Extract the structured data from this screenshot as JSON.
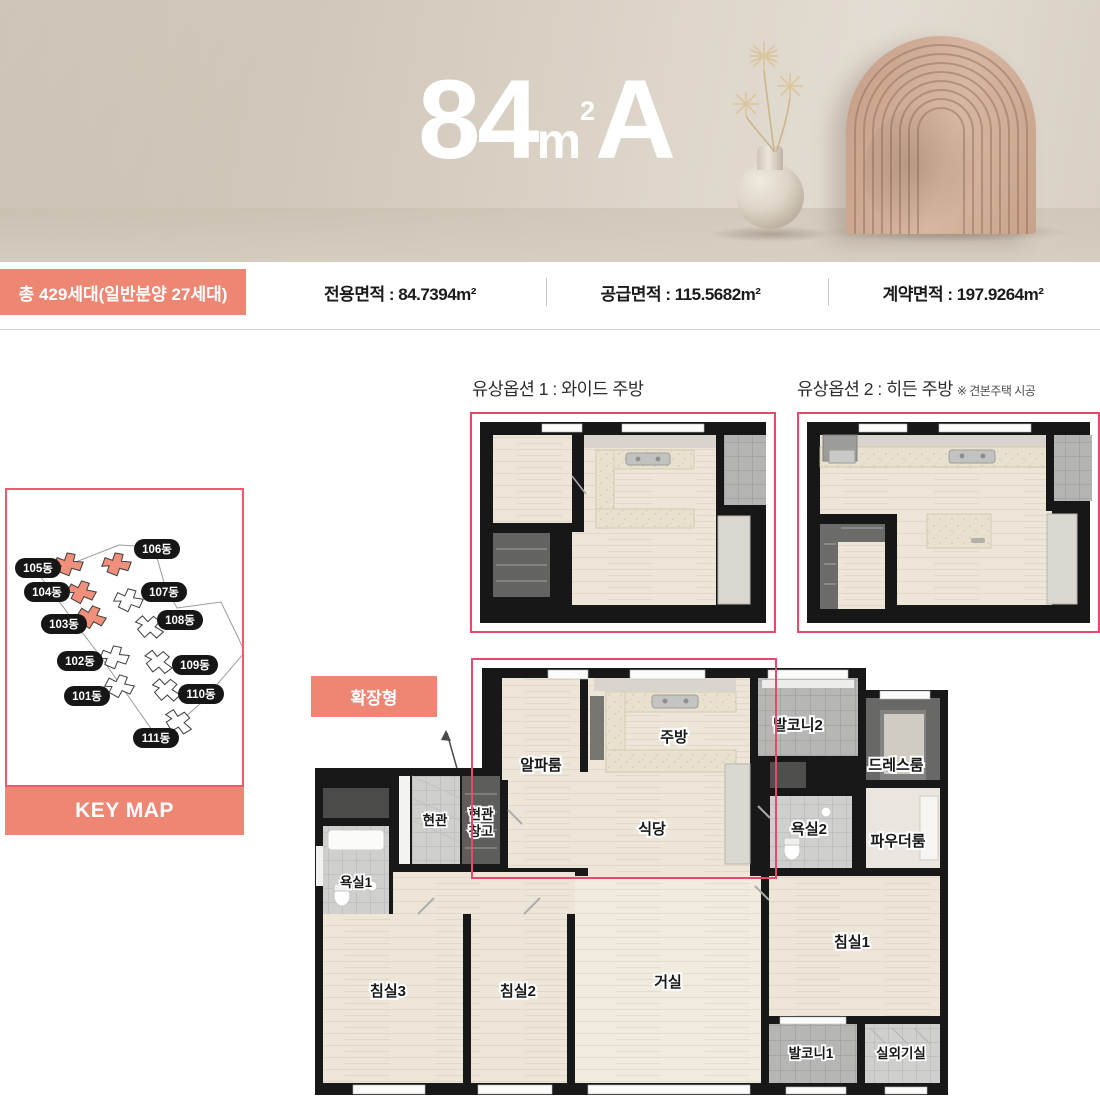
{
  "hero": {
    "title_num": "84",
    "title_unit": "m",
    "title_sup": "2",
    "title_suffix": "A"
  },
  "info": {
    "badge": "총 429세대(일반분양 27세대)",
    "items": [
      {
        "text": "전용면적 : 84.7394m²"
      },
      {
        "text": "공급면적 : 115.5682m²"
      },
      {
        "text": "계약면적 : 197.9264m²"
      }
    ]
  },
  "options": [
    {
      "label": "유상옵션 1 :  와이드 주방",
      "note": ""
    },
    {
      "label": "유상옵션 2 :  히든 주방",
      "note": "※ 견본주택 시공"
    }
  ],
  "keymap": {
    "title": "KEY MAP",
    "buildings": [
      {
        "label": "101동"
      },
      {
        "label": "102동"
      },
      {
        "label": "103동"
      },
      {
        "label": "104동"
      },
      {
        "label": "105동"
      },
      {
        "label": "106동"
      },
      {
        "label": "107동"
      },
      {
        "label": "108동"
      },
      {
        "label": "109동"
      },
      {
        "label": "110동"
      },
      {
        "label": "111동"
      }
    ]
  },
  "plan": {
    "badge": "확장형",
    "rooms": {
      "alpha": "알파룸",
      "kitchen": "주방",
      "balcony2": "발코니2",
      "dress": "드레스룸",
      "dining": "식당",
      "bath2": "욕실2",
      "powder": "파우더룸",
      "entry": "현관",
      "entry_storage_l1": "현관",
      "entry_storage_l2": "창고",
      "bath1": "욕실1",
      "bed3": "침실3",
      "bed2": "침실2",
      "living": "거실",
      "bed1": "침실1",
      "balcony1": "발코니1",
      "ac": "실외기실"
    }
  },
  "colors": {
    "brand_coral": "#ED8672",
    "accent_pink": "#E8496B"
  }
}
